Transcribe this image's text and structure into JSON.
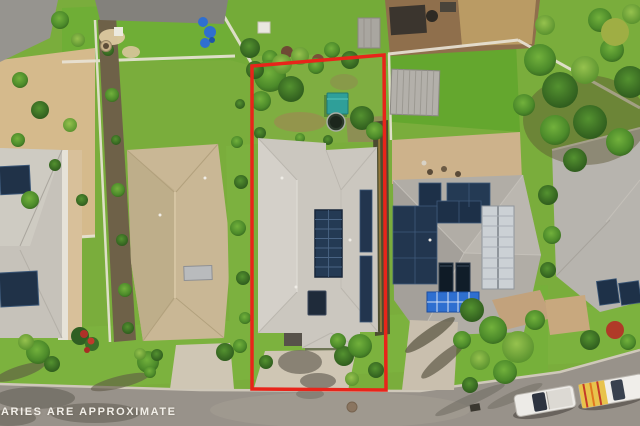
{
  "watermark": {
    "text": "ARIES ARE APPROXIMATE"
  },
  "boundary": {
    "stroke": "#e8241a"
  },
  "palette": {
    "grass": "#7aad3c",
    "lawn_bright": "#64a72e",
    "road": "#98928a",
    "curb": "#cfc8ba",
    "sand": "#d5ba8c",
    "dirt": "#8f6f4c",
    "driveway": "#cfc6b4",
    "roof_subject": "#cbc7bf",
    "roof_left": "#c9b795",
    "roof_right": "#b1ada6",
    "roof_far_left": "#c6c2ba",
    "roof_far_right": "#b7b4ae",
    "solar_navy": "#243a54",
    "solar_blue": "#2e6fd0",
    "solar_white": "#ccd1d5",
    "shed_teal": "#2f9f99",
    "truck_white": "#edebe7"
  }
}
